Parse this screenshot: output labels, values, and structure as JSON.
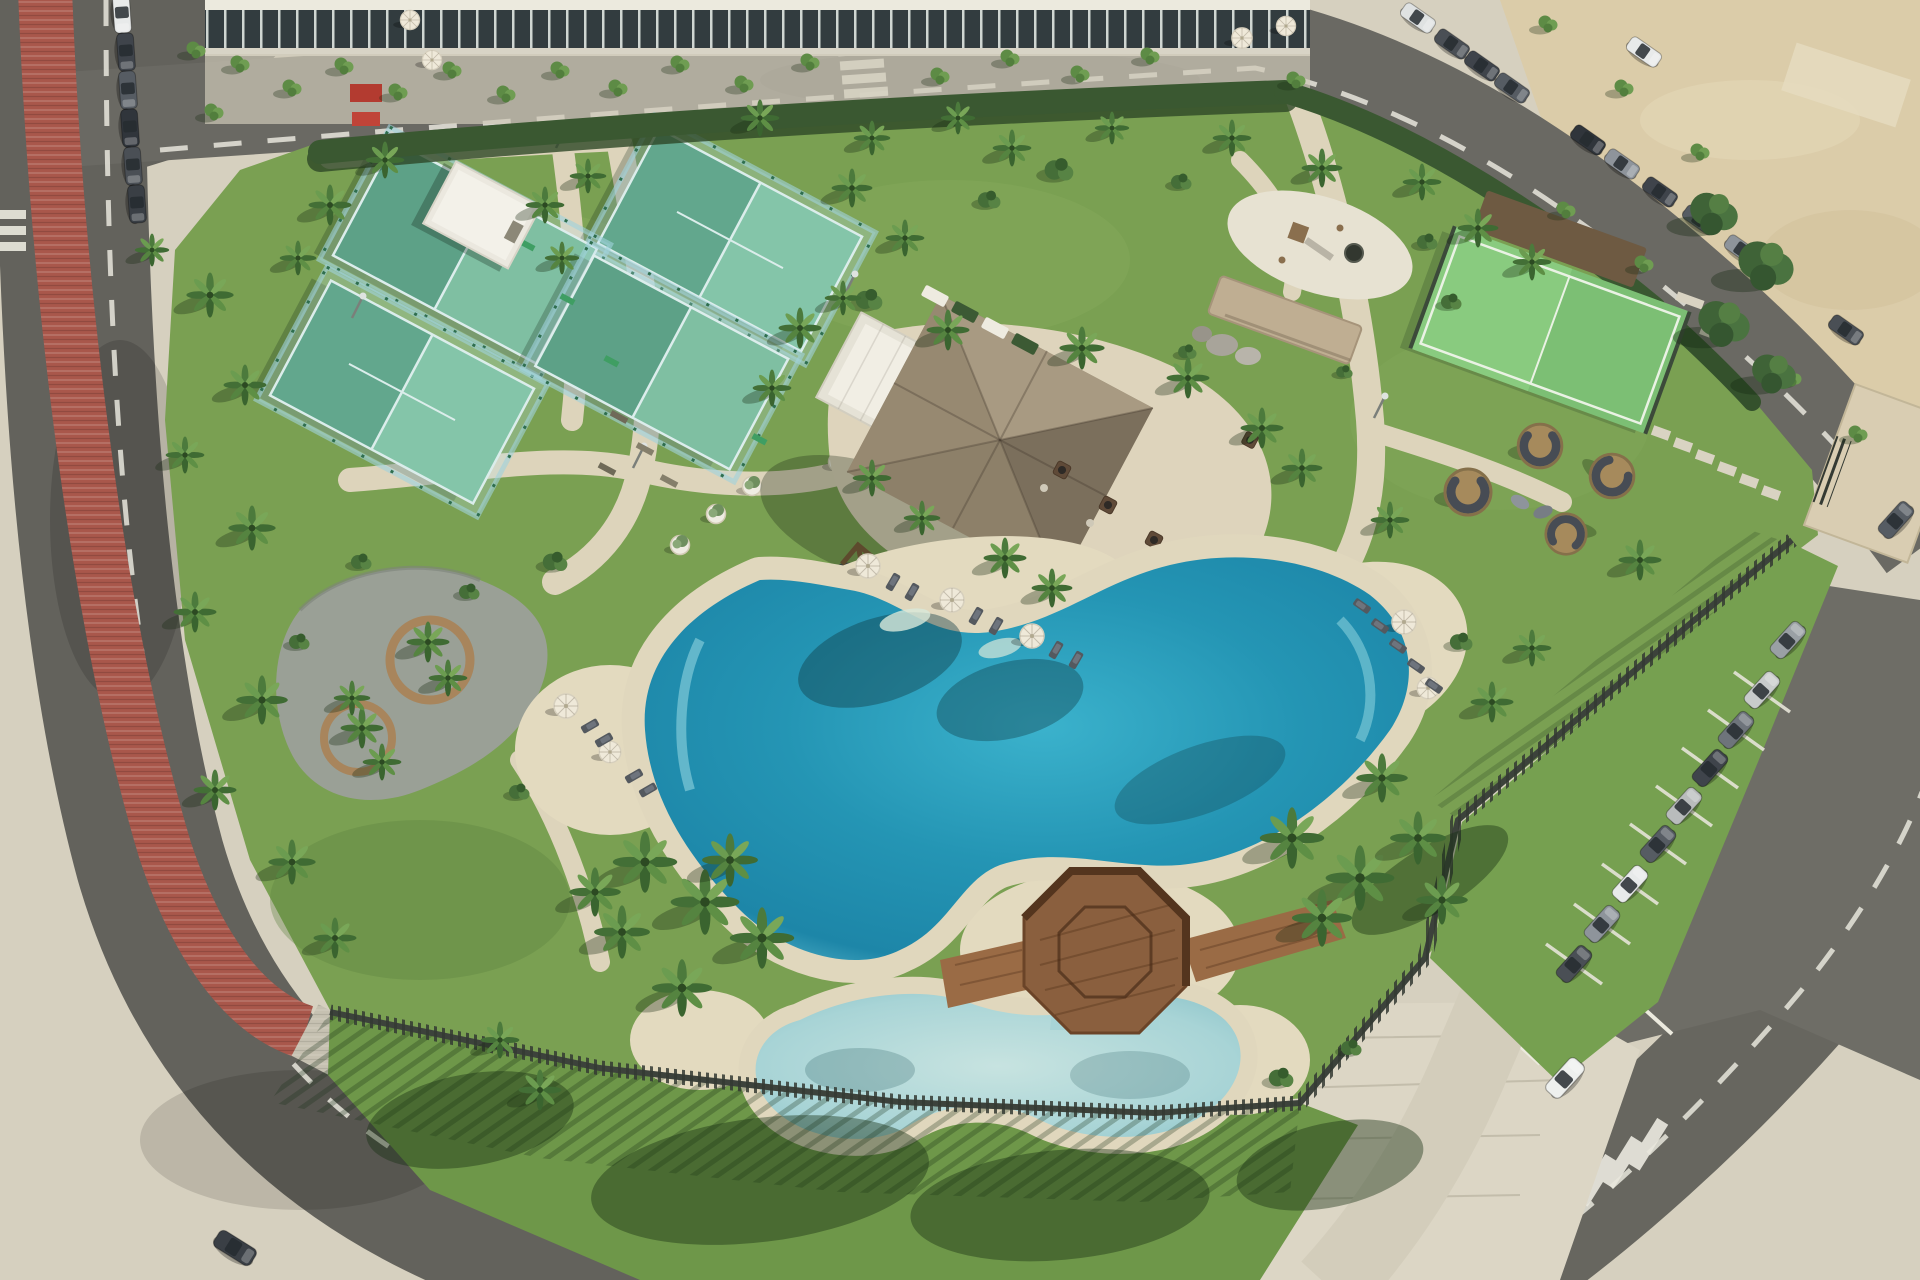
{
  "scene": {
    "title": "Aerial drone view of a resort-style community amenity park",
    "description": "Rendered aerial photograph of a landscaped leisure park: four glass-walled padel courts, a thatched-roof pool bar pavilion, a lagoon-style main pool with sandy beach edges, a shallow kids pool linked by an octagonal timber gazebo bridge, palm-lined lawns, a playground, a mini turf court, lounge pods, a perimeter road with a red bike lane, and parking lots with cars.",
    "palette": {
      "grass": "#7aa052",
      "grass_shade": "#57793c",
      "sand_path": "#ddd4bb",
      "beach_sand": "#e3dabf",
      "plaza_paving": "#dcd6c5",
      "asphalt": "#63625c",
      "bike_lane_red": "#a9574b",
      "pool_deep": "#1d86a8",
      "pool_light": "#8fd8e2",
      "kids_pool": "#a8d4d6",
      "court_turf": "#41916a",
      "court_turf_sunlit": "#79c197",
      "thatch_roof": "#94866f",
      "white_building": "#efece2",
      "timber": "#8a5f3e",
      "fence_slats": "#3c423b",
      "hedge": "#3a5831",
      "palm_canopy": "#4a7340",
      "sand_lot": "#dbcca9",
      "car_white": "#e8eaea",
      "car_dark": "#3f444b"
    },
    "features": [
      "perimeter road",
      "red bike lane",
      "padel courts",
      "storage shed",
      "pool bar pavilion with thatched roof",
      "main lagoon pool",
      "kids pool",
      "octagonal gazebo deck",
      "sun loungers and parasols",
      "circular bench plaza",
      "swing frames",
      "outdoor gym benches",
      "playground",
      "mini turf court",
      "lounge pods",
      "stone feature wall",
      "slatted perimeter fence",
      "east parking lot",
      "north-west parking bay",
      "sand lot",
      "zebra crossings"
    ],
    "counts": {
      "padel_courts": 4,
      "pools": 2,
      "parasols": 9,
      "parked_cars_estimate": 34
    }
  },
  "aria": {
    "scene": "Aerial view of resort amenity park",
    "roads": "Perimeter roads with dashed lane markings",
    "bike-lane": "Red bike and running lane along west road",
    "nw-buildings": "Commercial buildings and plaza at north-west",
    "sand-lot": "Unpaved sand lot at north-east",
    "park-lawn": "Main park lawn",
    "padel-courts": "Four padel courts with glass walls",
    "shed": "White storage building",
    "pavilion": "Pool bar pavilion with thatched roof",
    "stone-wall": "Stone feature wall with boulders",
    "playground": "Children playground pad",
    "mini-court": "Mini multi-sport turf court",
    "lounge-pods": "Rattan lounge pods on lawn",
    "bench-plaza": "Gravel plaza with circular timber benches",
    "main-pool": "Lagoon-style main swimming pool",
    "kids-pool": "Shallow kids pool",
    "gazebo": "Octagonal timber gazebo bridge",
    "fence": "Dark slatted perimeter fence",
    "parking-east": "East parking lot with angled stalls",
    "parking-nw": "Parallel parking bay, north-west road",
    "plaza": "Paved entrance plaza at south-east",
    "crosswalk": "Zebra crossing",
    "palm": "Palm tree",
    "tree": "Tree",
    "car": "Parked car",
    "umbrella": "Sun parasol",
    "lounger": "Sun lounger"
  }
}
